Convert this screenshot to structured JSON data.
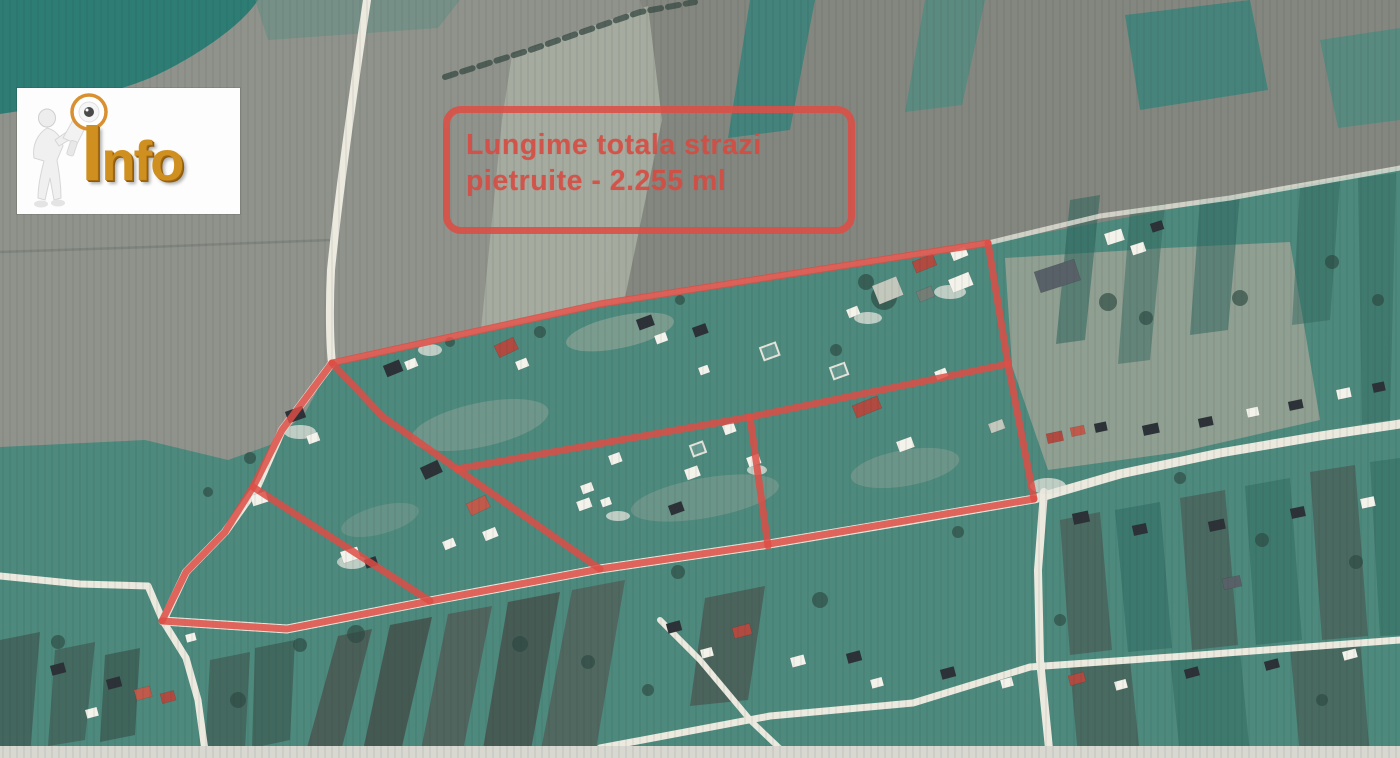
{
  "logo": {
    "text": "Info"
  },
  "annotation_box": {
    "line1": "Lungime totala strazi",
    "line2": "pietruite - 2.255 ml",
    "text_color": "#d94a41",
    "border_color": "#dd4e45"
  },
  "map": {
    "description": "Scanned aerial photo of a village; gravel streets outlined in red",
    "total_street_length": "2.255 ml",
    "marked_streets": {
      "color": "#dd4e45",
      "stroke_width": 7,
      "opacity": 0.85,
      "segments": [
        {
          "name": "left-boundary",
          "points": [
            [
              162,
              621
            ],
            [
              186,
              572
            ],
            [
              225,
              532
            ],
            [
              253,
              487
            ],
            [
              282,
              430
            ],
            [
              332,
              363
            ]
          ]
        },
        {
          "name": "north-boundary",
          "points": [
            [
              332,
              363
            ],
            [
              600,
              304
            ],
            [
              988,
              243
            ]
          ]
        },
        {
          "name": "east-boundary",
          "points": [
            [
              988,
              243
            ],
            [
              1008,
              364
            ],
            [
              1034,
              499
            ]
          ]
        },
        {
          "name": "south-boundary",
          "points": [
            [
              1034,
              499
            ],
            [
              763,
              545
            ],
            [
              600,
              569
            ],
            [
              430,
              601
            ],
            [
              287,
              629
            ],
            [
              162,
              621
            ]
          ]
        },
        {
          "name": "diagonal-street-1",
          "points": [
            [
              332,
              363
            ],
            [
              383,
              417
            ],
            [
              457,
              469
            ],
            [
              600,
              569
            ]
          ]
        },
        {
          "name": "diagonal-street-2",
          "points": [
            [
              253,
              487
            ],
            [
              430,
              601
            ]
          ]
        },
        {
          "name": "cross-street",
          "points": [
            [
              457,
              469
            ],
            [
              750,
              417
            ],
            [
              1008,
              364
            ]
          ]
        },
        {
          "name": "vertical-street",
          "points": [
            [
              750,
              417
            ],
            [
              768,
              546
            ]
          ]
        }
      ]
    }
  }
}
